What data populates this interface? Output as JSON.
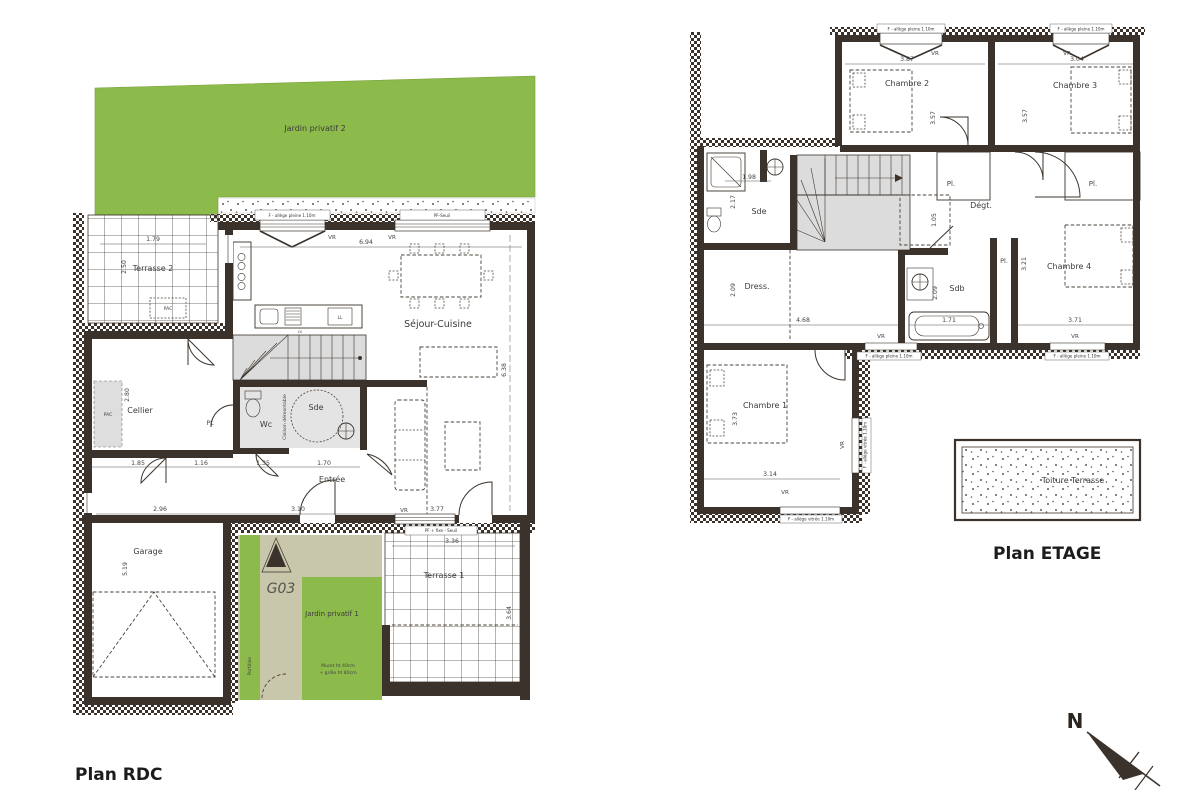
{
  "titles": {
    "rdc": "Plan RDC",
    "etage": "Plan ETAGE"
  },
  "compass": {
    "north": "N"
  },
  "colors": {
    "wall": "#3b332b",
    "garden_green": "#8cba4b",
    "path_beige": "#c9c7ab",
    "room_gray": "#e2e2e2"
  },
  "rdc": {
    "rooms": {
      "jardin2": "Jardin privatif 2",
      "terrasse2": "Terrasse 2",
      "sejour": "Séjour-Cuisine",
      "cellier": "Cellier",
      "wc": "Wc",
      "sde": "Sde",
      "entree": "Entrée",
      "garage": "Garage",
      "unit": "G03",
      "jardin1": "Jardin privatif 1",
      "terrasse1": "Terrasse 1",
      "pl": "PL",
      "pac": "PAC",
      "portillon": "Portillon",
      "muret1": "Muret ht 40cm",
      "muret2": "+ grille ht 80cm",
      "cloison": "Cloison démontable",
      "ll": "LL",
      "lv": "LV"
    },
    "windows": {
      "w1": "F - allège pleine 1.10m",
      "w2": "PF-Seuil",
      "w3": "PF + fixe - Seuil"
    },
    "vr": "VR",
    "dims": {
      "w694": "6.94",
      "t2w": "1.79",
      "t2h": "2.50",
      "cellh": "2.80",
      "d185": "1.85",
      "d116": "1.16",
      "d135": "1.35",
      "d170": "1.70",
      "gw": "2.96",
      "ew": "3.10",
      "sw": "3.77",
      "t1w": "3.36",
      "t1h": "3.64",
      "gh": "5.19",
      "sh": "6.38"
    }
  },
  "etage": {
    "rooms": {
      "ch1": "Chambre 1",
      "ch2": "Chambre 2",
      "ch3": "Chambre 3",
      "ch4": "Chambre 4",
      "sde": "Sde",
      "sdb": "Sdb",
      "dress": "Dress.",
      "degt": "Dégt.",
      "pl": "Pl.",
      "toiture": "Toiture Terrasse"
    },
    "windows": {
      "pleine": "F - allège pleine 1.10m",
      "vitree": "F - allège vitrée 1.10m"
    },
    "vr": "VR",
    "dims": {
      "ch2w": "3.87",
      "ch3w": "3.04",
      "ch2h": "3.57",
      "ch3h": "3.57",
      "sdew": "1.98",
      "sdeh": "2.17",
      "dressh": "2.09",
      "sdbh": "2.09",
      "trap": "1.05",
      "hall": "4.68",
      "bath": "1.71",
      "ch4w": "3.71",
      "ch4h": "3.21",
      "ch1h": "3.73",
      "ch1w": "3.14"
    }
  }
}
